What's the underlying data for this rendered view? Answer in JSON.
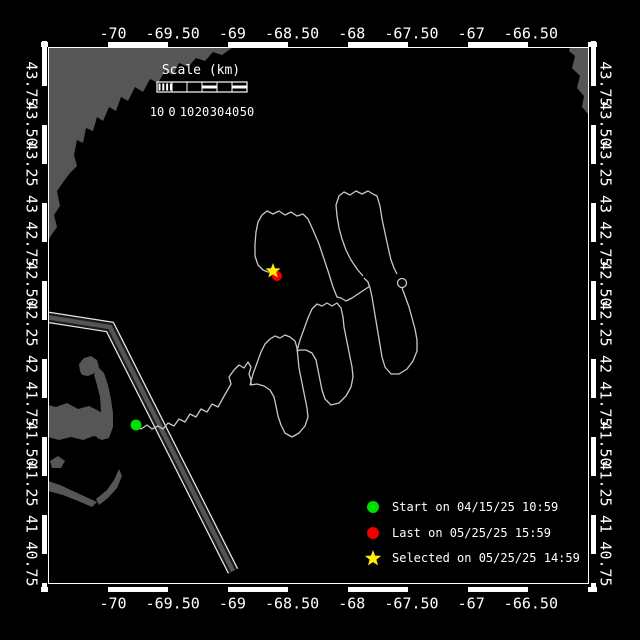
{
  "window": {
    "width": 640,
    "height": 640,
    "background": "#000000"
  },
  "axes": {
    "top_labels": [
      "-70",
      "-69.50",
      "-69",
      "-68.50",
      "-68",
      "-67.50",
      "-67",
      "-66.50"
    ],
    "bottom_labels": [
      "-70",
      "-69.50",
      "-69",
      "-68.50",
      "-68",
      "-67.50",
      "-67",
      "-66.50"
    ],
    "left_labels": [
      "43.75",
      "43.50",
      "43.25",
      "43",
      "42.75",
      "42.50",
      "42.25",
      "42",
      "41.75",
      "41.50",
      "41.25",
      "41",
      "40.75"
    ],
    "right_labels": [
      "43.75",
      "43.50",
      "43.25",
      "43",
      "42.75",
      "42.50",
      "42.25",
      "42",
      "41.75",
      "41.50",
      "41.25",
      "41",
      "40.75"
    ]
  },
  "scale_bar": {
    "title": "Scale (km)",
    "labels": [
      "10",
      "0",
      "10",
      "20",
      "30",
      "40",
      "50"
    ]
  },
  "legend": {
    "items": [
      {
        "marker": "circle",
        "color": "#00dd00",
        "label": "Start on 04/15/25 10:59"
      },
      {
        "marker": "circle",
        "color": "#ee0000",
        "label": "Last on 05/25/25 15:59"
      },
      {
        "marker": "star",
        "color": "#ffee00",
        "label": "Selected on 05/25/25 14:59"
      }
    ]
  },
  "markers": {
    "start": {
      "x": 136,
      "y": 425,
      "color": "#00dd00"
    },
    "last": {
      "x": 277,
      "y": 276,
      "color": "#ee0000"
    },
    "selected": {
      "x": 273,
      "y": 271,
      "color": "#ffee00"
    }
  },
  "track": {
    "color": "#c8c8c8",
    "segments": [
      [
        [
          136,
          425
        ],
        [
          141,
          429
        ],
        [
          147,
          425
        ],
        [
          152,
          429
        ],
        [
          158,
          426
        ],
        [
          163,
          429
        ],
        [
          168,
          423
        ],
        [
          174,
          426
        ],
        [
          179,
          419
        ],
        [
          185,
          422
        ],
        [
          190,
          414
        ],
        [
          196,
          417
        ],
        [
          201,
          409
        ],
        [
          207,
          412
        ],
        [
          212,
          404
        ],
        [
          218,
          407
        ],
        [
          223,
          398
        ],
        [
          227,
          391
        ],
        [
          231,
          384
        ],
        [
          229,
          377
        ],
        [
          234,
          370
        ],
        [
          239,
          365
        ],
        [
          244,
          368
        ],
        [
          248,
          362
        ],
        [
          251,
          367
        ],
        [
          249,
          374
        ],
        [
          251,
          380
        ],
        [
          251,
          385
        ]
      ],
      [
        [
          250,
          385
        ],
        [
          253,
          374
        ],
        [
          257,
          363
        ],
        [
          261,
          352
        ],
        [
          265,
          344
        ],
        [
          270,
          339
        ],
        [
          275,
          336
        ],
        [
          280,
          338
        ],
        [
          285,
          335
        ],
        [
          290,
          337
        ],
        [
          295,
          341
        ],
        [
          297,
          348
        ],
        [
          298,
          358
        ],
        [
          299,
          368
        ],
        [
          301,
          378
        ],
        [
          303,
          388
        ],
        [
          305,
          398
        ],
        [
          307,
          408
        ],
        [
          308,
          417
        ],
        [
          305,
          426
        ],
        [
          299,
          433
        ],
        [
          292,
          437
        ],
        [
          285,
          433
        ],
        [
          281,
          425
        ],
        [
          278,
          416
        ],
        [
          276,
          406
        ],
        [
          274,
          397
        ],
        [
          270,
          390
        ],
        [
          264,
          386
        ],
        [
          257,
          384
        ],
        [
          250,
          385
        ]
      ],
      [
        [
          297,
          351
        ],
        [
          300,
          340
        ],
        [
          304,
          329
        ],
        [
          308,
          318
        ],
        [
          312,
          309
        ],
        [
          317,
          304
        ],
        [
          322,
          306
        ],
        [
          327,
          303
        ],
        [
          332,
          306
        ],
        [
          337,
          303
        ],
        [
          341,
          308
        ],
        [
          343,
          317
        ],
        [
          344,
          327
        ],
        [
          346,
          337
        ],
        [
          348,
          347
        ],
        [
          350,
          357
        ],
        [
          352,
          367
        ],
        [
          353,
          377
        ],
        [
          351,
          387
        ],
        [
          346,
          396
        ],
        [
          339,
          403
        ],
        [
          331,
          405
        ],
        [
          325,
          399
        ],
        [
          322,
          390
        ],
        [
          320,
          380
        ],
        [
          318,
          370
        ],
        [
          316,
          360
        ],
        [
          312,
          353
        ],
        [
          306,
          350
        ],
        [
          300,
          350
        ],
        [
          297,
          351
        ]
      ],
      [
        [
          370,
          286
        ],
        [
          364,
          290
        ],
        [
          358,
          294
        ],
        [
          352,
          298
        ],
        [
          346,
          301
        ],
        [
          341,
          298
        ],
        [
          337,
          297
        ],
        [
          333,
          287
        ],
        [
          329,
          274
        ],
        [
          324,
          259
        ],
        [
          319,
          244
        ],
        [
          313,
          230
        ],
        [
          308,
          219
        ],
        [
          303,
          214
        ],
        [
          297,
          216
        ],
        [
          291,
          212
        ],
        [
          285,
          215
        ],
        [
          279,
          211
        ],
        [
          273,
          214
        ],
        [
          267,
          211
        ],
        [
          262,
          215
        ],
        [
          258,
          222
        ],
        [
          256,
          232
        ],
        [
          255,
          244
        ],
        [
          255,
          256
        ],
        [
          258,
          265
        ],
        [
          263,
          270
        ],
        [
          268,
          272
        ],
        [
          273,
          272
        ]
      ],
      [
        [
          363,
          276
        ],
        [
          357,
          269
        ],
        [
          351,
          260
        ],
        [
          346,
          250
        ],
        [
          342,
          239
        ],
        [
          339,
          228
        ],
        [
          337,
          216
        ],
        [
          336,
          205
        ],
        [
          339,
          196
        ],
        [
          344,
          192
        ],
        [
          350,
          195
        ],
        [
          356,
          191
        ],
        [
          362,
          194
        ],
        [
          368,
          191
        ],
        [
          373,
          194
        ],
        [
          377,
          196
        ],
        [
          380,
          206
        ],
        [
          382,
          219
        ],
        [
          385,
          233
        ],
        [
          388,
          247
        ],
        [
          391,
          260
        ],
        [
          394,
          268
        ],
        [
          397,
          274
        ]
      ],
      [
        [
          402,
          288
        ],
        [
          405,
          296
        ],
        [
          409,
          307
        ],
        [
          412,
          318
        ],
        [
          415,
          329
        ],
        [
          417,
          340
        ],
        [
          417,
          351
        ],
        [
          413,
          361
        ],
        [
          407,
          369
        ],
        [
          399,
          374
        ],
        [
          391,
          374
        ],
        [
          385,
          367
        ],
        [
          382,
          357
        ],
        [
          380,
          345
        ],
        [
          378,
          333
        ],
        [
          376,
          321
        ],
        [
          374,
          309
        ],
        [
          372,
          297
        ],
        [
          370,
          288
        ],
        [
          368,
          282
        ],
        [
          364,
          278
        ]
      ]
    ],
    "curl": {
      "cx": 402,
      "cy": 283,
      "r": 4.5
    }
  },
  "lane": {
    "points": [
      [
        46,
        317
      ],
      [
        110,
        327
      ],
      [
        233,
        571
      ]
    ],
    "edge_color": "#e8e8e8",
    "gap_color": "#1a1a1a",
    "core_color": "#555555"
  },
  "geography": {
    "land_color": "#565656",
    "polygons": [
      [
        [
          48,
          47
        ],
        [
          233,
          47
        ],
        [
          222,
          55
        ],
        [
          213,
          52
        ],
        [
          205,
          61
        ],
        [
          196,
          58
        ],
        [
          188,
          67
        ],
        [
          179,
          63
        ],
        [
          173,
          75
        ],
        [
          165,
          71
        ],
        [
          158,
          83
        ],
        [
          150,
          79
        ],
        [
          143,
          92
        ],
        [
          135,
          87
        ],
        [
          128,
          101
        ],
        [
          121,
          97
        ],
        [
          116,
          111
        ],
        [
          109,
          107
        ],
        [
          103,
          121
        ],
        [
          97,
          117
        ],
        [
          93,
          131
        ],
        [
          86,
          128
        ],
        [
          83,
          143
        ],
        [
          77,
          140
        ],
        [
          74,
          155
        ],
        [
          77,
          166
        ],
        [
          70,
          173
        ],
        [
          64,
          181
        ],
        [
          57,
          191
        ],
        [
          60,
          206
        ],
        [
          54,
          215
        ],
        [
          57,
          227
        ],
        [
          50,
          237
        ],
        [
          48,
          243
        ]
      ],
      [
        [
          570,
          47
        ],
        [
          588,
          47
        ],
        [
          588,
          114
        ],
        [
          582,
          107
        ],
        [
          584,
          96
        ],
        [
          577,
          88
        ],
        [
          580,
          76
        ],
        [
          572,
          68
        ],
        [
          575,
          56
        ],
        [
          569,
          51
        ]
      ],
      [
        [
          44,
          404
        ],
        [
          56,
          407
        ],
        [
          67,
          403
        ],
        [
          78,
          409
        ],
        [
          89,
          406
        ],
        [
          99,
          411
        ],
        [
          106,
          416
        ],
        [
          109,
          424
        ],
        [
          110,
          433
        ],
        [
          104,
          439
        ],
        [
          94,
          436
        ],
        [
          83,
          440
        ],
        [
          71,
          437
        ],
        [
          59,
          440
        ],
        [
          48,
          437
        ],
        [
          44,
          438
        ]
      ],
      [
        [
          97,
          438
        ],
        [
          100,
          425
        ],
        [
          101,
          411
        ],
        [
          100,
          397
        ],
        [
          97,
          385
        ],
        [
          94,
          375
        ],
        [
          98,
          367
        ],
        [
          104,
          373
        ],
        [
          108,
          385
        ],
        [
          111,
          399
        ],
        [
          113,
          413
        ],
        [
          113,
          427
        ],
        [
          109,
          438
        ],
        [
          102,
          440
        ]
      ],
      [
        [
          80,
          371
        ],
        [
          79,
          364
        ],
        [
          84,
          358
        ],
        [
          91,
          356
        ],
        [
          97,
          360
        ],
        [
          99,
          367
        ],
        [
          95,
          373
        ],
        [
          88,
          376
        ],
        [
          82,
          375
        ]
      ],
      [
        [
          50,
          461
        ],
        [
          58,
          456
        ],
        [
          65,
          461
        ],
        [
          61,
          468
        ],
        [
          52,
          468
        ]
      ],
      [
        [
          48,
          481
        ],
        [
          60,
          485
        ],
        [
          73,
          491
        ],
        [
          86,
          497
        ],
        [
          97,
          502
        ],
        [
          92,
          507
        ],
        [
          78,
          501
        ],
        [
          63,
          495
        ],
        [
          48,
          491
        ]
      ],
      [
        [
          96,
          499
        ],
        [
          107,
          490
        ],
        [
          114,
          480
        ],
        [
          119,
          469
        ],
        [
          122,
          476
        ],
        [
          117,
          488
        ],
        [
          108,
          498
        ],
        [
          99,
          505
        ]
      ]
    ]
  },
  "colors": {
    "frame": "#ffffff",
    "text": "#ffffff",
    "sea": "#000000"
  }
}
